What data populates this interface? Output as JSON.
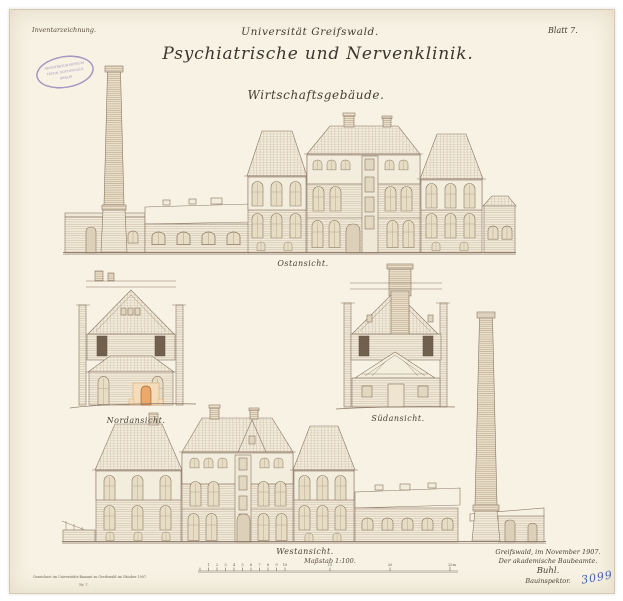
{
  "page": {
    "corner_note": "Inventarzeichnung.",
    "sheet_label": "Blatt 7.",
    "title": {
      "institution": "Universität Greifswald.",
      "main": "Psychiatrische und Nervenklinik.",
      "subtitle": "Wirtschaftsgebäude."
    },
    "views": {
      "east": "Ostansicht.",
      "north": "Nordansicht.",
      "south": "Südansicht.",
      "west": "Westansicht."
    },
    "scale_label": "Maßstab 1:100.",
    "scale_ticks": [
      "1",
      "2",
      "3",
      "4",
      "5",
      "6",
      "7",
      "8",
      "9",
      "10",
      "15",
      "20",
      "25m"
    ],
    "signature": [
      "Greifswald, im November 1907.",
      "Der akademische Baubeamte.",
      "Buhl.",
      "Bauinspektor."
    ],
    "inventory_number": "3099",
    "stamp": [
      "ARCHITEKTUR-MUSEUM",
      "TECHN. HOCHSCHULE",
      "BERLIN"
    ],
    "print_note": [
      "Gezeichnet im Universitäts-Bauamt zu Greifswald im Oktober 1907.",
      "Nr. 7."
    ]
  }
}
